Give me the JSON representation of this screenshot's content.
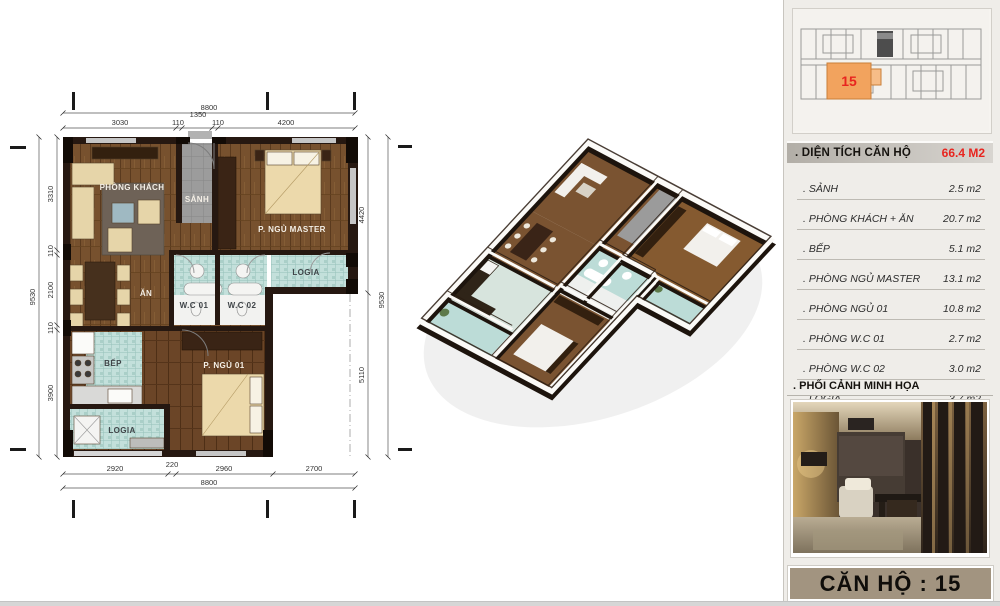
{
  "floor_plan": {
    "labels": {
      "living": "PHÒNG KHÁCH",
      "hall": "SẢNH",
      "master_bedroom": "P. NGỦ MASTER",
      "dining": "ĂN",
      "wc1": "W.C 01",
      "wc2": "W.C 02",
      "logia_mid": "LOGIA",
      "kitchen": "BẾP",
      "bedroom_01": "P. NGỦ 01",
      "logia_bottom": "LOGIA"
    },
    "dims": {
      "top_total": "8800",
      "top_segments": [
        "3030",
        "110",
        "1350",
        "110",
        "4200"
      ],
      "bottom_segments": [
        "2920",
        "220",
        "2960",
        "2700"
      ],
      "bottom_total": "8800",
      "left_total": "9530",
      "left_segments": [
        "3310",
        "110",
        "2100",
        "110",
        "3900"
      ],
      "right_segments": [
        "4420",
        "5110"
      ],
      "right_total": "9530"
    }
  },
  "key_plan": {
    "highlight_unit": "15"
  },
  "info_panel": {
    "area_header": {
      "label": ". DIỆN TÍCH CĂN HỘ",
      "value": "66.4 M2"
    },
    "room_areas": [
      {
        "label": ". SẢNH",
        "value": "2.5 m2"
      },
      {
        "label": ". PHÒNG KHÁCH + ĂN",
        "value": "20.7 m2"
      },
      {
        "label": ". BẾP",
        "value": "5.1 m2"
      },
      {
        "label": ". PHÒNG NGỦ MASTER",
        "value": "13.1 m2"
      },
      {
        "label": ". PHÒNG NGỦ 01",
        "value": "10.8 m2"
      },
      {
        "label": ". PHÒNG W.C 01",
        "value": "2.7 m2"
      },
      {
        "label": ". PHÒNG W.C 02",
        "value": "3.0 m2"
      },
      {
        "label": ". LOGIA",
        "value": "3.7 m2"
      }
    ],
    "perspective_header": ". PHỐI CẢNH MINH HỌA",
    "unit_bar": "CĂN HỘ : 15"
  },
  "colors": {
    "accent_red": "#e8251f",
    "highlight_orange": "#f2a35e",
    "unit_bar_bg": "#a29480",
    "wall_dark": "#261811",
    "tile_teal": "#c3e0db",
    "hall_gray": "#9c9c9c"
  }
}
